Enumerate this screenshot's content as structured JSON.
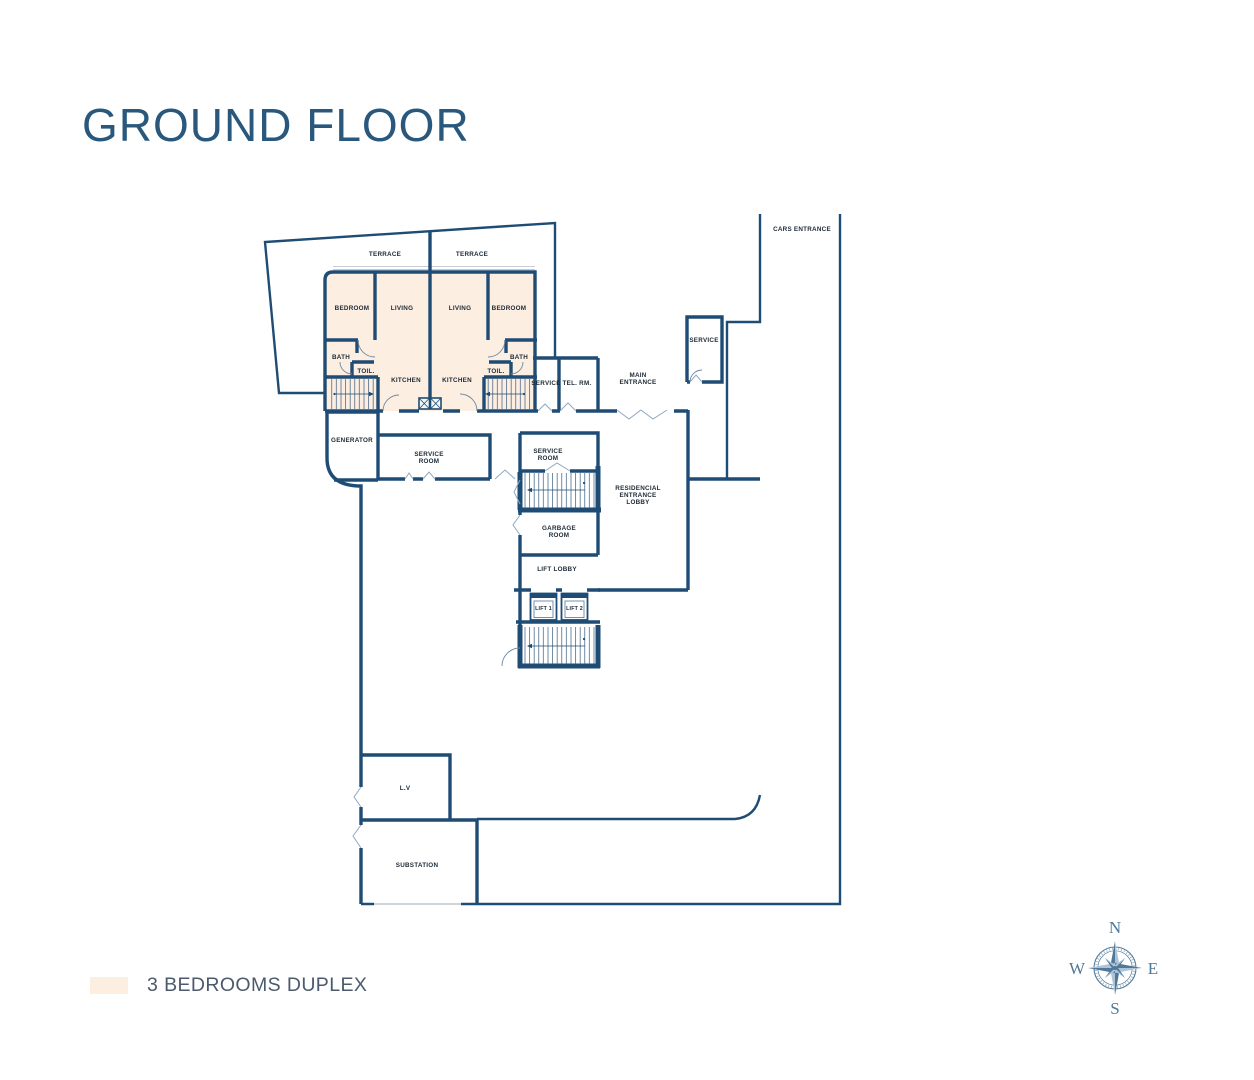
{
  "page": {
    "title": "GROUND FLOOR"
  },
  "legend": {
    "label": "3 BEDROOMS DUPLEX"
  },
  "colors": {
    "wall": "#1f4c74",
    "unit_fill": "#fdeee2",
    "title_text": "#29587c",
    "legend_text": "#4b5a6d",
    "compass": "#4f7899"
  },
  "compass": {
    "n": "N",
    "s": "S",
    "e": "E",
    "w": "W"
  },
  "rooms": {
    "terrace": "TERRACE",
    "bedroom": "BEDROOM",
    "living": "LIVING",
    "bath": "BATH",
    "toilet": "TOIL.",
    "kitchen": "KITCHEN",
    "service": "SERVICE",
    "tel_room": "TEL. RM.",
    "main_entrance": [
      "MAIN",
      "ENTRANCE"
    ],
    "cars_entrance": "CARS ENTRANCE",
    "generator": "GENERATOR",
    "service_room": [
      "SERVICE",
      "ROOM"
    ],
    "residencial_lobby": [
      "RESIDENCIAL",
      "ENTRANCE",
      "LOBBY"
    ],
    "garbage_room": [
      "GARBAGE",
      "ROOM"
    ],
    "lift_lobby": "LIFT LOBBY",
    "lift_1": "LIFT 1",
    "lift_2": "LIFT 2",
    "lv": "L.V",
    "substation": "SUBSTATION"
  }
}
